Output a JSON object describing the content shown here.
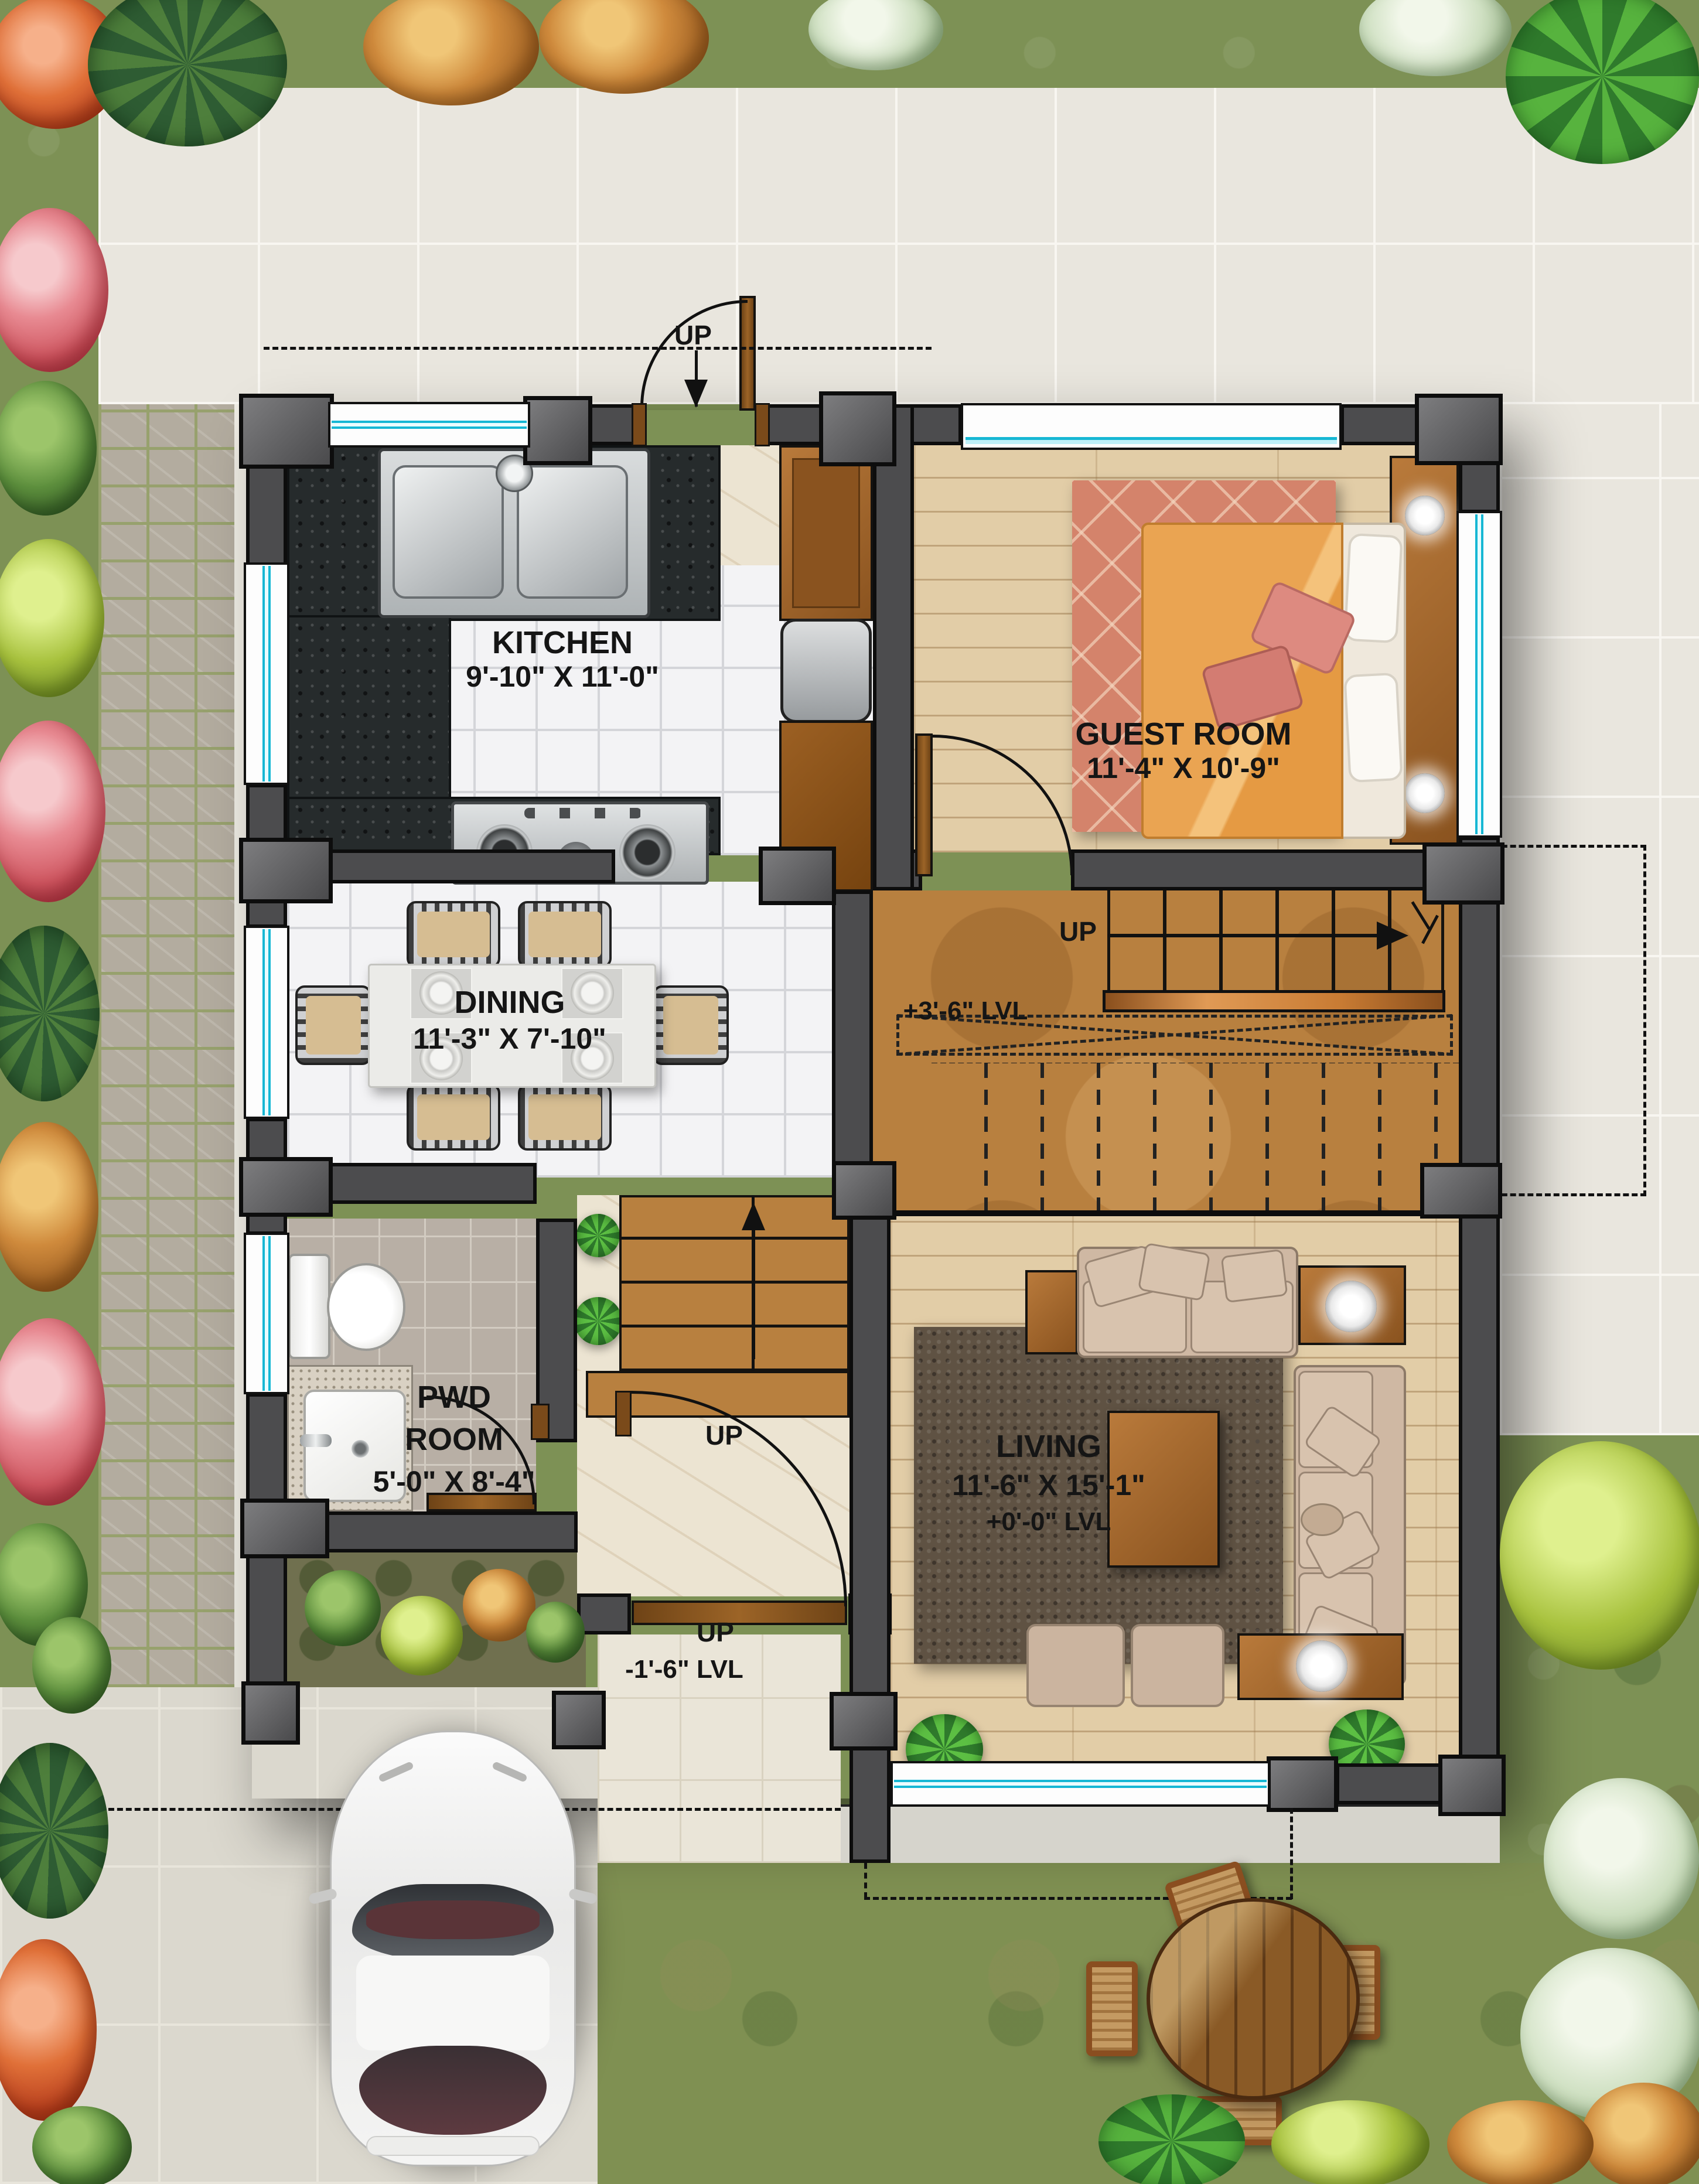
{
  "rooms": {
    "kitchen": {
      "name": "KITCHEN",
      "dims": "9'-10\" X 11'-0\""
    },
    "guest": {
      "name": "GUEST ROOM",
      "dims": "11'-4\" X 10'-9\""
    },
    "dining": {
      "name": "DINING",
      "dims": "11'-3\" X 7'-10\""
    },
    "pwd": {
      "line1": "PWD",
      "line2": "ROOM",
      "dims": "5'-0\" X 8'-4\""
    },
    "living": {
      "name": "LIVING",
      "dims": "11'-6\" X 15'-1\"",
      "level": "+0'-0\" LVL"
    }
  },
  "stairs": {
    "main_up": "UP",
    "main_level": "+3'-6\" LVL",
    "foyer_up": "UP",
    "entrance_up": "UP",
    "porch_up": "UP",
    "porch_level": "-1'-6\" LVL"
  },
  "colors": {
    "wall": "#4c4c4e",
    "window_glass": "#16b7d4",
    "door_wood": "#8a5a22",
    "granite_counter": "#262b2c",
    "hall_wood": "#b8803f",
    "room_wood": "#e2cda7",
    "guest_rug": "#d4836b",
    "living_rug": "#5f5243",
    "sofa": "#cfb8a3",
    "grass": "#7d9155",
    "patio": "#e9e6de",
    "cobblestone": "#b3ac9f",
    "driveway": "#dbd8ce"
  }
}
